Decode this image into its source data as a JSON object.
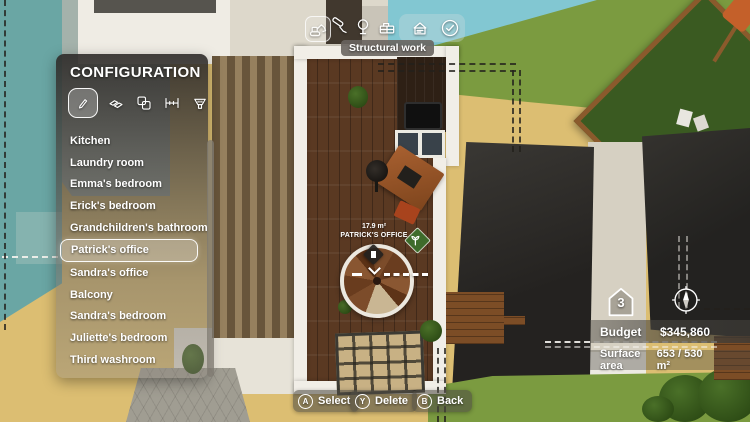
{
  "toolbar": {
    "tooltip": "Structural work",
    "icons": [
      "excavator-icon",
      "paint-roller-icon",
      "tree-icon",
      "furniture-icon",
      "house-upload-icon",
      "check-icon"
    ]
  },
  "config": {
    "title": "CONFIGURATION",
    "tool_icons": [
      "pencil-icon",
      "materials-icon",
      "rooms-icon",
      "measure-icon",
      "funnel-icon"
    ],
    "rooms": [
      "Kitchen",
      "Laundry room",
      "Emma's bedroom",
      "Erick's bedroom",
      "Grandchildren's bathroom",
      "Patrick's office",
      "Sandra's office",
      "Balcony",
      "Sandra's bedroom",
      "Juliette's bedroom",
      "Third washroom"
    ],
    "selected_room": "Patrick's office"
  },
  "room_overlay": {
    "area": "17.9 m²",
    "name": "PATRICK'S OFFICE"
  },
  "status": {
    "floor": "3",
    "budget_label": "Budget",
    "budget_value": "$345,860",
    "surface_label": "Surface area",
    "surface_value": "653 / 530 m²"
  },
  "hints": [
    {
      "key": "A",
      "label": "Select"
    },
    {
      "key": "Y",
      "label": "Delete"
    },
    {
      "key": "B",
      "label": "Back"
    }
  ],
  "colors": {
    "pool": "#6aa6a4",
    "water": "#82c7d2",
    "grass": "#7b9b40",
    "sand": "#dcbe72",
    "roof": "#2b2927",
    "canopy": "#3a5a21",
    "wood_floor": "#5a3922",
    "wall": "#f1eee7"
  }
}
